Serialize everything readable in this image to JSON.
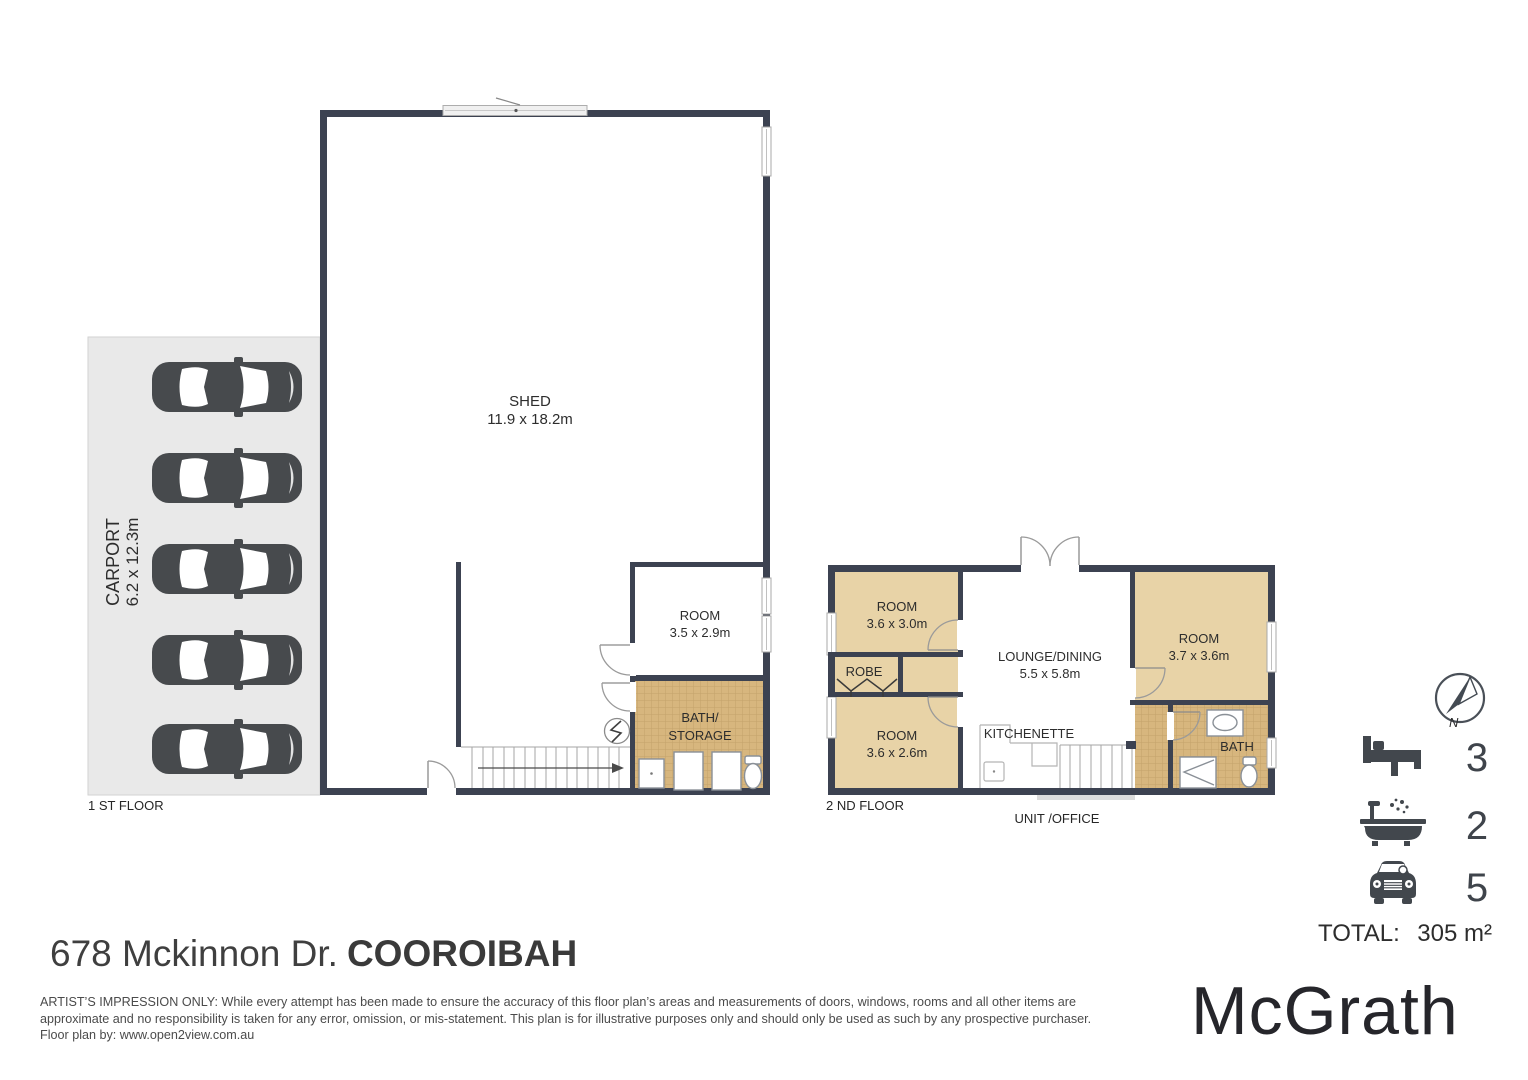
{
  "first_floor": {
    "floor_label": "1 ST FLOOR",
    "carport": {
      "name": "CARPORT",
      "dims": "6.2 x 12.3m"
    },
    "shed": {
      "name": "SHED",
      "dims": "11.9 x 18.2m"
    },
    "room": {
      "name": "ROOM",
      "dims": "3.5 x 2.9m"
    },
    "bath_storage": {
      "name_line1": "BATH/",
      "name_line2": "STORAGE"
    }
  },
  "second_floor": {
    "floor_label": "2 ND FLOOR",
    "unit_label": "UNIT /OFFICE",
    "room_top_left": {
      "name": "ROOM",
      "dims": "3.6 x 3.0m"
    },
    "robe": {
      "name": "ROBE"
    },
    "room_bottom_left": {
      "name": "ROOM",
      "dims": "3.6 x 2.6m"
    },
    "lounge_dining": {
      "name": "LOUNGE/DINING",
      "dims": "5.5 x 5.8m"
    },
    "kitchenette": {
      "name": "KITCHENETTE"
    },
    "room_right": {
      "name": "ROOM",
      "dims": "3.7 x 3.6m"
    },
    "bath": {
      "name": "BATH"
    }
  },
  "compass": {
    "north_label": "N"
  },
  "summary": {
    "bedrooms": "3",
    "bathrooms": "2",
    "car_spaces": "5",
    "total_label": "TOTAL:",
    "total_value": "305 m²"
  },
  "footer": {
    "address_street": "678 Mckinnon Dr.",
    "address_suburb": "COOROIBAH",
    "disclaimer_line1": "ARTIST’S IMPRESSION ONLY: While every attempt has been made to ensure the accuracy of this floor plan’s areas and measurements of doors, windows, rooms and all other items are",
    "disclaimer_line2": "approximate and no responsibility is taken for any error, omission, or mis-statement. This plan is for illustrative purposes only and should only be used as such by any prospective purchaser.",
    "disclaimer_line3": "Floor plan by: www.open2view.com.au",
    "brand": "McGrath"
  },
  "colors": {
    "wall": "#3c4251",
    "room_fill": "#e8d3a7",
    "tile_fill": "#d7b67e",
    "carport_fill": "#e9e9e9"
  }
}
